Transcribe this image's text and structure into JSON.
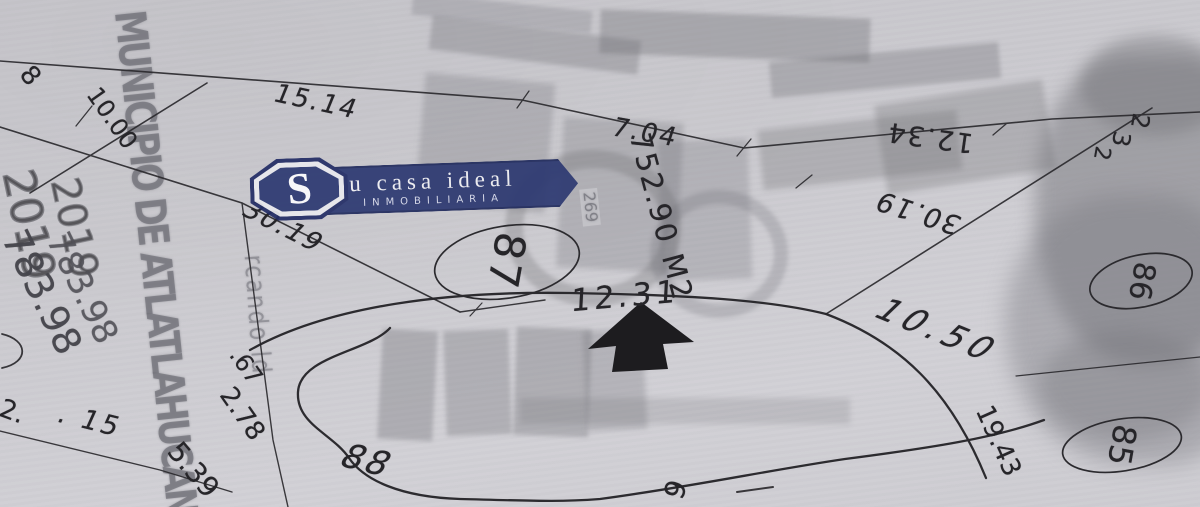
{
  "document": {
    "type_hint": "photographed cadastral lot plan",
    "colors": {
      "paper": "#cac9ce",
      "ink": "#262529",
      "stamp_gray": "#76767d",
      "navy": "#2e3a72"
    }
  },
  "watermark": {
    "badge_letter": "S",
    "line1": "u casa ideal",
    "line2": "INMOBILIARIA"
  },
  "stamp": {
    "municipality": "MUNICIPIO DE ATLATLAHUCAN",
    "year": "2019",
    "folio": "783.98",
    "side_text": "rcando ld",
    "box_number": "269"
  },
  "labels": {
    "area": "752.90 M2",
    "m1514": "15.14",
    "m704": "7.04",
    "m1234": "12.34",
    "m1000": "10.00",
    "m3019a": "30.19",
    "m3019b": "30.19",
    "m1231": "12.31",
    "m1050": "10.50",
    "m1943": "19.43",
    "m67": ".67",
    "m278": "2.78",
    "m539": "5.39",
    "m15": ". 15",
    "m2dot": "2.",
    "lot87": "87",
    "lot86": "86",
    "lot85": "85",
    "lot88": "88",
    "p8": "8",
    "p2a": "2",
    "p3": "3",
    "p2b": "2",
    "p6": "6"
  }
}
